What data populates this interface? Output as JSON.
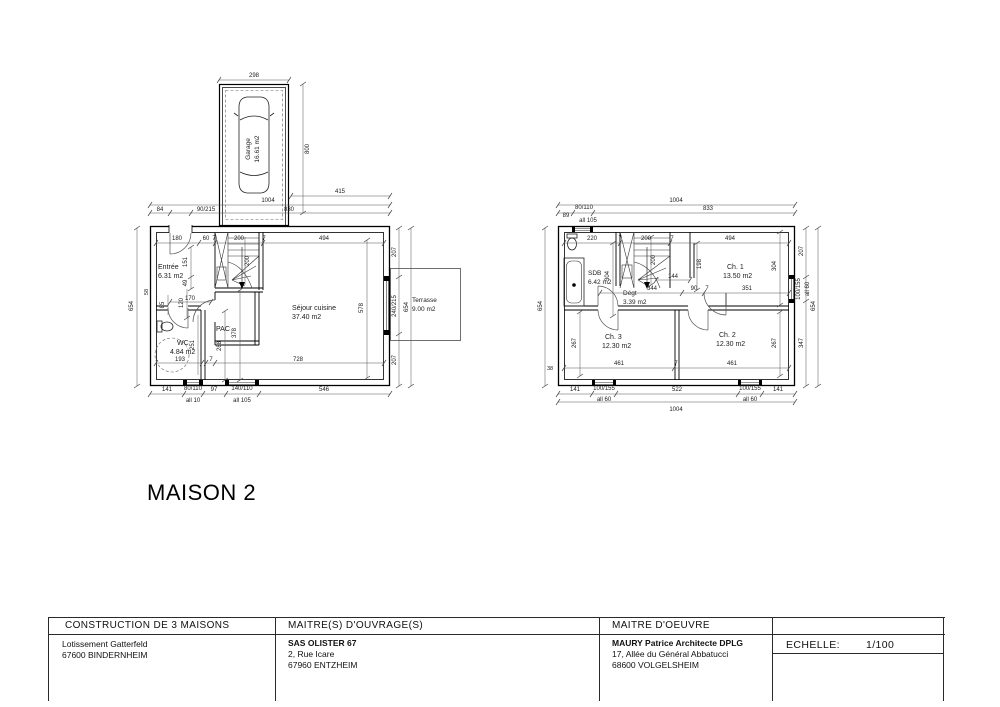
{
  "title": "MAISON 2",
  "gf": {
    "rooms": {
      "garage": {
        "name": "Garage",
        "area": "16.61 m2"
      },
      "entree": {
        "name": "Entrée",
        "area": "6.31 m2"
      },
      "wc": {
        "name": "WC",
        "area": "4.84 m2"
      },
      "pac": {
        "name": "PAC"
      },
      "sejour": {
        "name": "Séjour cuisine",
        "area": "37.40 m2"
      },
      "terrasse": {
        "name": "Terrasse",
        "area": "9.00 m2"
      }
    },
    "dims": {
      "d298": "298",
      "d800": "800",
      "d415": "415",
      "d1004": "1004",
      "d84": "84",
      "d90_215": "90/215",
      "d830": "830",
      "t180": "180",
      "t60": "60",
      "t7a": "7",
      "t200": "200",
      "t7b": "7",
      "t494": "494",
      "v151": "151",
      "v49": "49",
      "v120": "120",
      "v85": "85",
      "h170": "170",
      "v200": "200",
      "v251": "251",
      "v288": "288",
      "v378": "378",
      "v578": "578",
      "v58": "58",
      "h193": "193",
      "h7": "7",
      "h728": "728",
      "l654": "654",
      "r207a": "207",
      "r240": "240/215",
      "r207b": "207",
      "r654": "654",
      "b141": "141",
      "bw1": "80/110",
      "bw1a": "all 10",
      "b97": "97",
      "bw2": "140/110",
      "bw2a": "all 105",
      "b546": "546"
    }
  },
  "ff": {
    "rooms": {
      "sdb": {
        "name": "SDB",
        "area": "6.42 m2"
      },
      "degt": {
        "name": "Dégt",
        "area": "3.39 m2"
      },
      "ch1": {
        "name": "Ch. 1",
        "area": "13.50 m2"
      },
      "ch2": {
        "name": "Ch. 2",
        "area": "12.30 m2"
      },
      "ch3": {
        "name": "Ch. 3",
        "area": "12.30 m2"
      }
    },
    "dims": {
      "t89": "89",
      "tw": "80/110",
      "twa": "all 105",
      "t1004": "1004",
      "t833": "833",
      "i220": "220",
      "i7a": "7",
      "i200": "200",
      "i7b": "7",
      "i494": "494",
      "v304l": "304",
      "v200": "200",
      "v198": "198",
      "h144": "144",
      "h344": "344",
      "h90": "90",
      "h7": "7",
      "h351": "351",
      "v304r": "304",
      "v267l": "267",
      "v267r": "267",
      "ib461a": "461",
      "ib7": "7",
      "ib461b": "461",
      "v38": "38",
      "b141a": "141",
      "bw1": "100/155",
      "bw1a": "all 60",
      "b522": "522",
      "bw2": "100/155",
      "bw2a": "all 60",
      "b141b": "141",
      "b1004": "1004",
      "r207": "207",
      "rw": "100/155",
      "rwa": "all 60",
      "r347": "347",
      "r654": "654",
      "l654": "654"
    }
  },
  "title_block": {
    "project": {
      "header": "CONSTRUCTION DE 3 MAISONS",
      "line1": "Lotissement Gatterfeld",
      "line2": "67600 BINDERNHEIM"
    },
    "owner": {
      "header": "MAITRE(S)  D'OUVRAGE(S)",
      "name": "SAS OLISTER 67",
      "line1": "2, Rue Icare",
      "line2": "67960 ENTZHEIM"
    },
    "architect": {
      "header": "MAITRE  D'OEUVRE",
      "name": "MAURY Patrice Architecte DPLG",
      "line1": "17, Allée du Général Abbatucci",
      "line2": "68600 VOLGELSHEIM"
    },
    "scale": {
      "label": "ECHELLE:",
      "value": "1/100"
    }
  }
}
